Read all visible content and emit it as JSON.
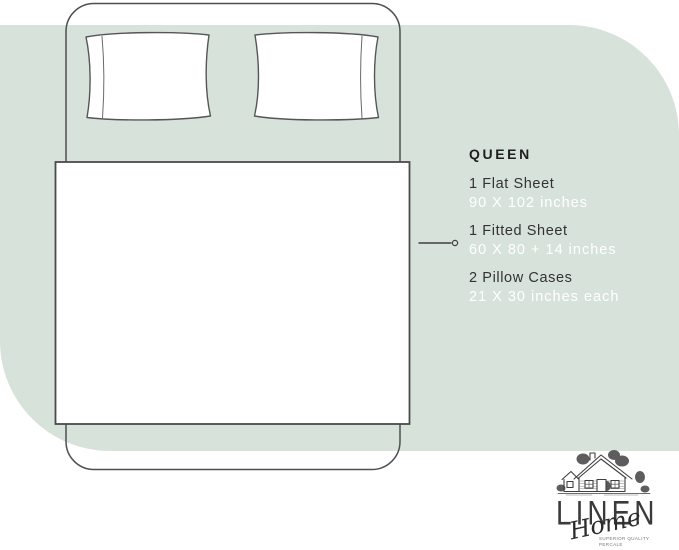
{
  "specs": {
    "title": "QUEEN",
    "items": [
      {
        "name": "1 Flat Sheet",
        "dimensions": "90 X 102 inches"
      },
      {
        "name": "1 Fitted Sheet",
        "dimensions": "60 X 80 + 14 inches"
      },
      {
        "name": "2 Pillow Cases",
        "dimensions": "21 X 30 inches each"
      }
    ]
  },
  "logo": {
    "brand": "LINEN",
    "script": "Home",
    "tagline_line1": "SUPERIOR QUALITY",
    "tagline_line2": "PERCALE"
  },
  "icons": {
    "bed_diagram": "top-view bed with two pillows, flat sheet and callout dot",
    "house": "hand-drawn cottage illustration"
  },
  "colors": {
    "page_background": "#ffffff",
    "accent_green": "#d7e3da",
    "line_ink": "#4a4a4a",
    "text_dark": "#2e2e2e",
    "text_white": "#ffffff"
  }
}
